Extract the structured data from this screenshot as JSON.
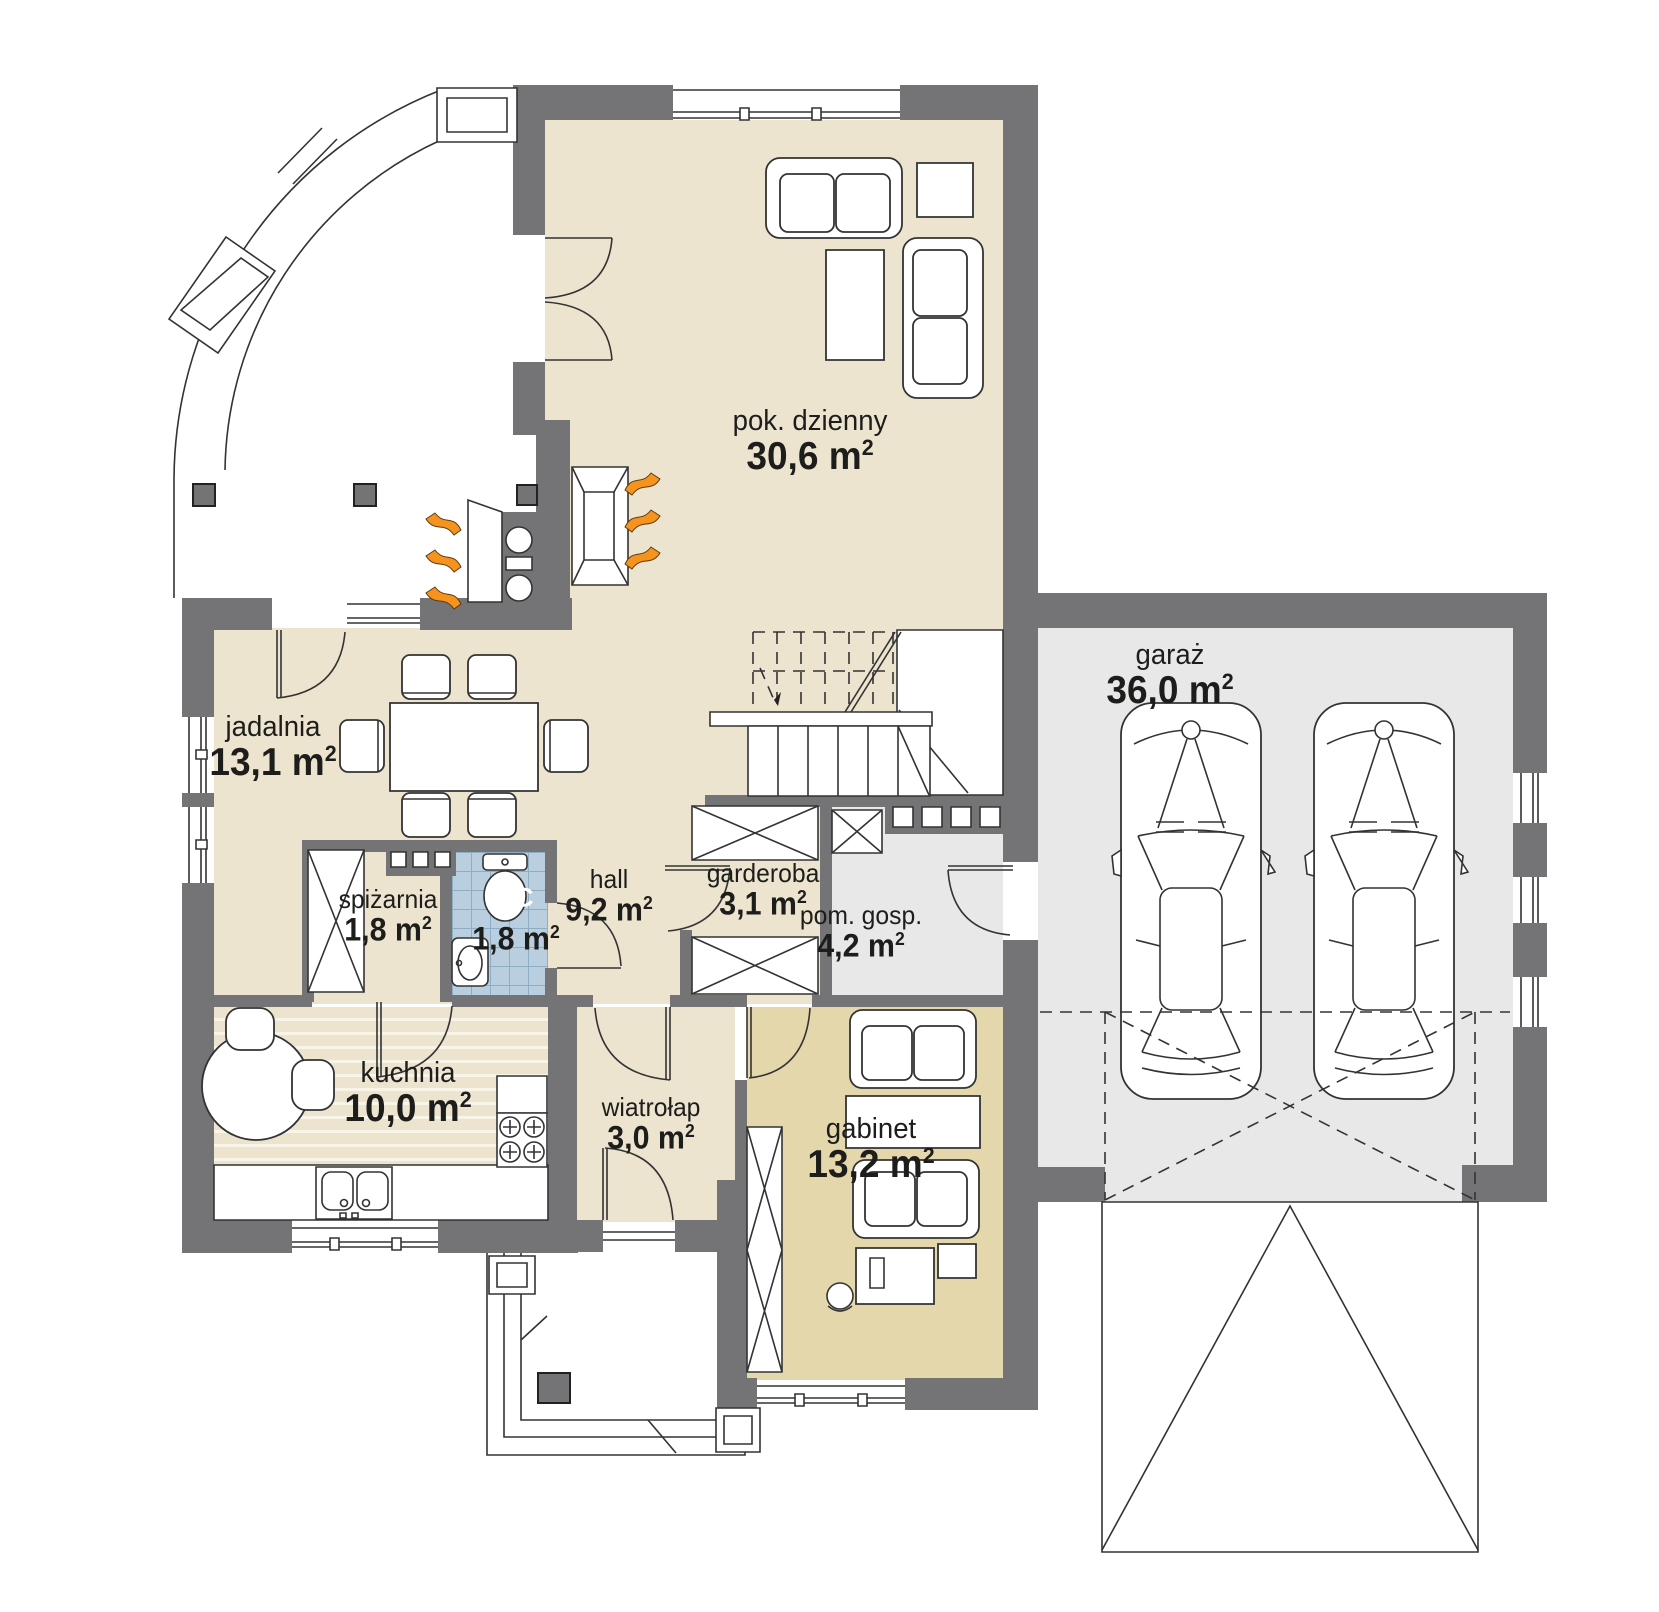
{
  "title": "house ground-floor plan",
  "units": {
    "m": " m",
    "sup": "2"
  },
  "colors": {
    "wall": "#747477",
    "floor-beige": "#ece4cf",
    "floor-tan": "#e5d7ac",
    "floor-gray": "#e8e8e8",
    "tile-blue": "#b9cfdf",
    "tile-line": "#8fadc2",
    "accent-orange": "#f6921e",
    "line": "#333333",
    "text": "#1d1d1b"
  },
  "rooms": [
    {
      "key": "pok-dzienny",
      "name": "pok. dzienny",
      "area": "30,6"
    },
    {
      "key": "garaz",
      "name": "garaż",
      "area": "36,0"
    },
    {
      "key": "jadalnia",
      "name": "jadalnia",
      "area": "13,1"
    },
    {
      "key": "garderoba",
      "name": "garderoba",
      "area": "3,1"
    },
    {
      "key": "pom-gosp",
      "name": "pom. gosp.",
      "area": "4,2"
    },
    {
      "key": "spizarnia",
      "name": "spiżarnia",
      "area": "1,8"
    },
    {
      "key": "wc",
      "name": "WC",
      "area": "1,8"
    },
    {
      "key": "hall",
      "name": "hall",
      "area": "9,2"
    },
    {
      "key": "kuchnia",
      "name": "kuchnia",
      "area": "10,0"
    },
    {
      "key": "wiatrolap",
      "name": "wiatrołap",
      "area": "3,0"
    },
    {
      "key": "gabinet",
      "name": "gabinet",
      "area": "13,2"
    }
  ]
}
